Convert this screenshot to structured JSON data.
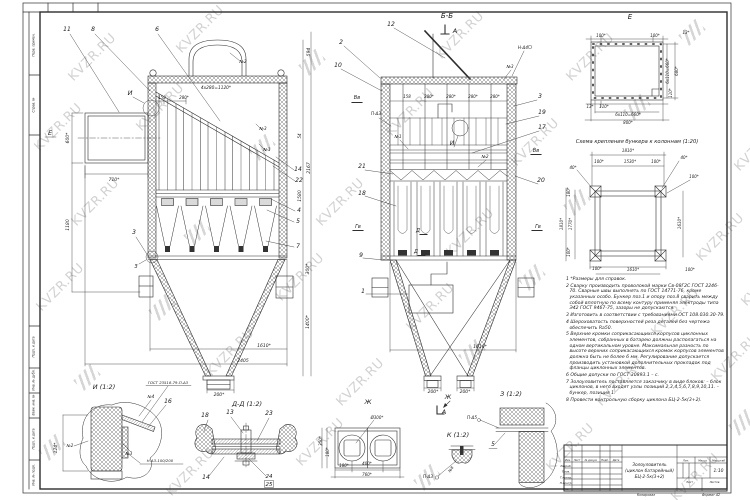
{
  "watermark": {
    "text": "KVZR.RU"
  },
  "sheet": {
    "margin_labels": [
      "Перв. примен.",
      "Справ. №",
      "Подп. и дата",
      "Инв. № дубл.",
      "Взам. инв. №",
      "Подп. и дата",
      "Инв. № подл."
    ],
    "footer": {
      "left": "Копировал",
      "right": "Формат А2"
    }
  },
  "notes": [
    "1 *Размеры для справок.",
    "2 Сварку производить проволокой марки Св-08Г2С ГОСТ 2246-70. Сварные швы выполнять по ГОСТ 14771-76, кроме указанных особо. Бункер поз.1 и опору поз.8 сварить между собой вплотную по всему контуру применяя электроды типа Э42 ГОСТ 9467-75, зазоры не допускаются.",
    "3 Изготовить в соответствии с требованиями ОСТ 108.030.30-79.",
    "4 Шероховатость поверхностей реза деталей без чертежа обеспечить Ra50.",
    "5 Верхние кромки соприкасающихся корпусов циклонных элементов, собранных в батарею должны располагаться на одном вертикальном уровне. Максимальная разность по высоте верхних соприкасающихся кромок корпусов элементов должна быть не более 6 мм. Регулирование допускается производить установкой дополнительных прокладок под фланцы циклонных элементов.",
    "6 Общие допуски по ГОСТ 30893.1 – с.",
    "7 Золоуловитель поставляется заказчику в виде блоков: – блок циклонов, в него входят узлы позиций 2,3,4,5,6,7,8,9,10,11. – бункер, позиция 1.",
    "8 Провести контрольную сборку циклона БЦ-2-5к(3+2)."
  ],
  "title_block": {
    "product": [
      "Золоуловитель",
      "(циклон батарейный)",
      "БЦ-2-5к(3+2)"
    ],
    "scale_value": "1:10",
    "col_headers": [
      "Изм.",
      "Лист",
      "№ докум.",
      "Подп.",
      "Дата"
    ],
    "row_headers": [
      "Разраб.",
      "Пров.",
      "Т.контр.",
      "Н.контр.",
      "Утв."
    ],
    "right_headers": [
      "Лит.",
      "Масса",
      "Масштаб"
    ],
    "bottom_headers": [
      "Лист",
      "Листов"
    ]
  },
  "labels": [
    {
      "t": "11",
      "x": 67,
      "y": 31,
      "fs": 6
    },
    {
      "t": "8",
      "x": 93,
      "y": 31,
      "fs": 6
    },
    {
      "t": "6",
      "x": 157,
      "y": 31,
      "fs": 6
    },
    {
      "t": "№2",
      "x": 243,
      "y": 63,
      "fs": 4.3
    },
    {
      "t": "4х280=1120*",
      "x": 216,
      "y": 89,
      "fs": 4.3
    },
    {
      "t": "158",
      "x": 162,
      "y": 99,
      "fs": 4
    },
    {
      "t": "280*",
      "x": 184,
      "y": 99,
      "fs": 4
    },
    {
      "t": "И",
      "x": 130,
      "y": 95,
      "fs": 6.5
    },
    {
      "t": "Е",
      "x": 50,
      "y": 135,
      "fs": 6.5
    },
    {
      "t": "600*",
      "x": 69,
      "y": 138,
      "r": -90,
      "fs": 4.5
    },
    {
      "t": "710*",
      "x": 114,
      "y": 181,
      "fs": 4.5
    },
    {
      "t": "1180",
      "x": 69,
      "y": 225,
      "r": -90,
      "fs": 4.5
    },
    {
      "t": "3",
      "x": 134,
      "y": 234,
      "fs": 6
    },
    {
      "t": "З",
      "x": 136,
      "y": 268,
      "fs": 5
    },
    {
      "t": "14",
      "x": 298,
      "y": 171,
      "fs": 6
    },
    {
      "t": "22",
      "x": 299,
      "y": 182,
      "fs": 6
    },
    {
      "t": "4",
      "x": 299,
      "y": 212,
      "fs": 6
    },
    {
      "t": "5",
      "x": 298,
      "y": 223,
      "fs": 6
    },
    {
      "t": "7",
      "x": 298,
      "y": 248,
      "fs": 6
    },
    {
      "t": "№3",
      "x": 263,
      "y": 130,
      "fs": 4.3
    },
    {
      "t": "№1",
      "x": 267,
      "y": 151,
      "fs": 4.3
    },
    {
      "t": "594",
      "x": 310,
      "y": 52,
      "r": -90,
      "fs": 4.5
    },
    {
      "t": "54",
      "x": 301,
      "y": 136,
      "r": -90,
      "fs": 4
    },
    {
      "t": "2167",
      "x": 310,
      "y": 168,
      "r": -90,
      "fs": 4.5
    },
    {
      "t": "1580",
      "x": 301,
      "y": 196,
      "r": -90,
      "fs": 4.5
    },
    {
      "t": "300*",
      "x": 309,
      "y": 269,
      "r": -90,
      "fs": 4.5
    },
    {
      "t": "1400*",
      "x": 309,
      "y": 322,
      "r": -90,
      "fs": 4.5
    },
    {
      "t": "1610*",
      "x": 264,
      "y": 347,
      "fs": 4.5
    },
    {
      "t": "2405",
      "x": 243,
      "y": 362,
      "fs": 4.5
    },
    {
      "t": "200*",
      "x": 219,
      "y": 396,
      "fs": 4.5
    },
    {
      "t": "Б-Б",
      "x": 447,
      "y": 18,
      "fs": 7
    },
    {
      "t": "А",
      "x": 455,
      "y": 33,
      "fs": 6.5
    },
    {
      "t": "12",
      "x": 391,
      "y": 26,
      "fs": 6
    },
    {
      "t": "2",
      "x": 341,
      "y": 44,
      "fs": 6
    },
    {
      "t": "10",
      "x": 338,
      "y": 67,
      "fs": 6
    },
    {
      "t": "Н-Δ4",
      "x": 523,
      "y": 49,
      "fs": 4.2
    },
    {
      "t": "№3",
      "x": 510,
      "y": 68,
      "fs": 4.2
    },
    {
      "t": "Вв",
      "x": 357,
      "y": 99,
      "fs": 5
    },
    {
      "t": "158",
      "x": 407,
      "y": 98,
      "fs": 4
    },
    {
      "t": "280*",
      "x": 429,
      "y": 98,
      "fs": 4
    },
    {
      "t": "280*",
      "x": 451,
      "y": 98,
      "fs": 4
    },
    {
      "t": "280*",
      "x": 473,
      "y": 98,
      "fs": 4
    },
    {
      "t": "280*",
      "x": 495,
      "y": 98,
      "fs": 4
    },
    {
      "t": "3",
      "x": 540,
      "y": 98,
      "fs": 6
    },
    {
      "t": "19",
      "x": 542,
      "y": 114,
      "fs": 6
    },
    {
      "t": "17",
      "x": 542,
      "y": 129,
      "fs": 6
    },
    {
      "t": "П-Δ3",
      "x": 376,
      "y": 115,
      "fs": 4.2
    },
    {
      "t": "№1",
      "x": 398,
      "y": 138,
      "fs": 4.2
    },
    {
      "t": "И",
      "x": 452,
      "y": 145,
      "fs": 6
    },
    {
      "t": "№2",
      "x": 485,
      "y": 158,
      "fs": 4.2
    },
    {
      "t": "Вв",
      "x": 536,
      "y": 152,
      "fs": 5
    },
    {
      "t": "21",
      "x": 362,
      "y": 168,
      "fs": 6
    },
    {
      "t": "20",
      "x": 541,
      "y": 182,
      "fs": 6
    },
    {
      "t": "18",
      "x": 362,
      "y": 195,
      "fs": 6
    },
    {
      "t": "Гв",
      "x": 358,
      "y": 228,
      "fs": 5
    },
    {
      "t": "Гв",
      "x": 538,
      "y": 228,
      "fs": 5
    },
    {
      "t": "Д",
      "x": 418,
      "y": 232,
      "fs": 5
    },
    {
      "t": "Д",
      "x": 416,
      "y": 253,
      "fs": 5
    },
    {
      "t": "9",
      "x": 361,
      "y": 257,
      "fs": 6
    },
    {
      "t": "1",
      "x": 363,
      "y": 293,
      "fs": 6
    },
    {
      "t": "1610*",
      "x": 480,
      "y": 348,
      "fs": 4.5
    },
    {
      "t": "200*",
      "x": 433,
      "y": 393,
      "fs": 4.5
    },
    {
      "t": "200*",
      "x": 465,
      "y": 393,
      "fs": 4.5
    },
    {
      "t": "Ж",
      "x": 448,
      "y": 399,
      "fs": 6
    },
    {
      "t": "А",
      "x": 444,
      "y": 414,
      "fs": 6.5
    },
    {
      "t": "Е",
      "x": 630,
      "y": 19,
      "fs": 7
    },
    {
      "t": "100*",
      "x": 601,
      "y": 37,
      "fs": 4
    },
    {
      "t": "100*",
      "x": 655,
      "y": 37,
      "fs": 4
    },
    {
      "t": "13*",
      "x": 686,
      "y": 34,
      "fs": 4
    },
    {
      "t": "6х110=660*",
      "x": 669,
      "y": 71,
      "r": -90,
      "fs": 4
    },
    {
      "t": "680*",
      "x": 678,
      "y": 71,
      "r": -90,
      "fs": 4
    },
    {
      "t": "110*",
      "x": 672,
      "y": 93,
      "r": -90,
      "fs": 4
    },
    {
      "t": "13*",
      "x": 590,
      "y": 108,
      "fs": 4
    },
    {
      "t": "110*",
      "x": 604,
      "y": 108,
      "fs": 4
    },
    {
      "t": "6х110=660*",
      "x": 628,
      "y": 116,
      "fs": 4
    },
    {
      "t": "800*",
      "x": 628,
      "y": 124,
      "fs": 4
    },
    {
      "t": "Схема крепления бункера к колоннам (1:20)",
      "x": 637,
      "y": 143,
      "fs": 5.2
    },
    {
      "t": "1810*",
      "x": 628,
      "y": 152,
      "fs": 4
    },
    {
      "t": "100*",
      "x": 599,
      "y": 163,
      "fs": 4
    },
    {
      "t": "1530*",
      "x": 630,
      "y": 163,
      "fs": 4
    },
    {
      "t": "100*",
      "x": 656,
      "y": 163,
      "fs": 4
    },
    {
      "t": "40*",
      "x": 684,
      "y": 159,
      "fs": 4
    },
    {
      "t": "40*",
      "x": 573,
      "y": 169,
      "fs": 4
    },
    {
      "t": "100*",
      "x": 694,
      "y": 178,
      "fs": 4
    },
    {
      "t": "180*",
      "x": 570,
      "y": 192,
      "r": -90,
      "fs": 4
    },
    {
      "t": "1810*",
      "x": 563,
      "y": 224,
      "r": -90,
      "fs": 4
    },
    {
      "t": "1770*",
      "x": 572,
      "y": 224,
      "r": -90,
      "fs": 4
    },
    {
      "t": "1610*",
      "x": 681,
      "y": 223,
      "r": -90,
      "fs": 4
    },
    {
      "t": "100*",
      "x": 570,
      "y": 252,
      "r": -90,
      "fs": 4
    },
    {
      "t": "100*",
      "x": 597,
      "y": 270,
      "fs": 4
    },
    {
      "t": "1610*",
      "x": 633,
      "y": 271,
      "fs": 4
    },
    {
      "t": "100*",
      "x": 690,
      "y": 271,
      "fs": 4
    },
    {
      "t": "И (1:2)",
      "x": 104,
      "y": 389,
      "fs": 6.5
    },
    {
      "t": "ГОСТ 23518-79-П-Δ3",
      "x": 168,
      "y": 384,
      "fs": 3.8
    },
    {
      "t": "№4",
      "x": 151,
      "y": 398,
      "fs": 4
    },
    {
      "t": "16",
      "x": 168,
      "y": 403,
      "fs": 6
    },
    {
      "t": "№2",
      "x": 70,
      "y": 447,
      "fs": 4
    },
    {
      "t": "124*",
      "x": 57,
      "y": 448,
      "r": -90,
      "fs": 4.5
    },
    {
      "t": "№3",
      "x": 129,
      "y": 455,
      "fs": 4
    },
    {
      "t": "Н-Δ3-100/200",
      "x": 160,
      "y": 462,
      "fs": 3.8
    },
    {
      "t": "Д-Д (1:2)",
      "x": 247,
      "y": 406,
      "fs": 6.5
    },
    {
      "t": "18",
      "x": 205,
      "y": 417,
      "fs": 6
    },
    {
      "t": "13",
      "x": 230,
      "y": 414,
      "fs": 6
    },
    {
      "t": "23",
      "x": 269,
      "y": 415,
      "fs": 6
    },
    {
      "t": "14",
      "x": 206,
      "y": 479,
      "fs": 6
    },
    {
      "t": "24",
      "x": 269,
      "y": 478,
      "fs": 5.5
    },
    {
      "t": "25",
      "x": 269,
      "y": 486,
      "fs": 5.5
    },
    {
      "t": "Ж",
      "x": 368,
      "y": 404,
      "fs": 6.5
    },
    {
      "t": "Ø300*",
      "x": 377,
      "y": 419,
      "fs": 4
    },
    {
      "t": "350*",
      "x": 322,
      "y": 441,
      "r": -90,
      "fs": 4
    },
    {
      "t": "180*",
      "x": 329,
      "y": 452,
      "r": -90,
      "fs": 4
    },
    {
      "t": "180*",
      "x": 344,
      "y": 467,
      "fs": 4
    },
    {
      "t": "400*",
      "x": 367,
      "y": 465,
      "fs": 4
    },
    {
      "t": "760*",
      "x": 367,
      "y": 476,
      "fs": 4
    },
    {
      "t": "К (1:2)",
      "x": 458,
      "y": 437,
      "fs": 6.5
    },
    {
      "t": "№8",
      "x": 452,
      "y": 470,
      "r": -55,
      "fs": 3.8
    },
    {
      "t": "П-Δ3",
      "x": 428,
      "y": 478,
      "fs": 4.2
    },
    {
      "t": "З (1:2)",
      "x": 511,
      "y": 396,
      "fs": 6.5
    },
    {
      "t": "П-Δ5",
      "x": 472,
      "y": 419,
      "fs": 4.2
    },
    {
      "t": "5",
      "x": 493,
      "y": 446,
      "fs": 6
    }
  ]
}
